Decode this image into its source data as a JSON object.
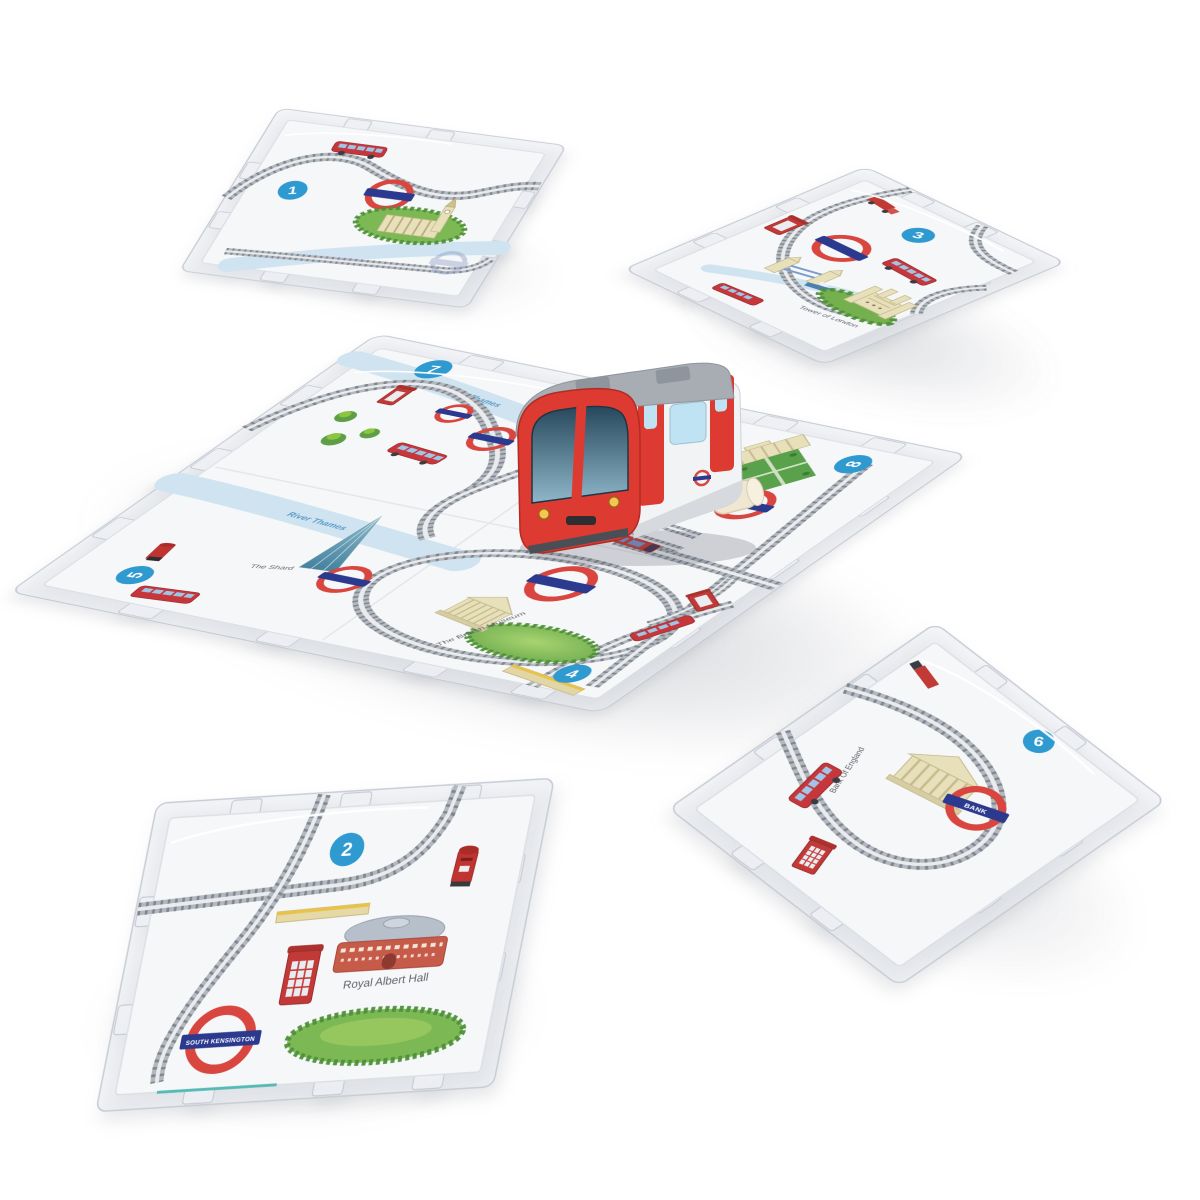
{
  "badges": {
    "t1": "1",
    "t2": "2",
    "t3": "3",
    "t4": "4",
    "t5": "5",
    "t6": "6",
    "t7": "7",
    "t8": "8"
  },
  "labels": {
    "river_thames": "River Thames",
    "the_shard": "The Shard",
    "british_museum": "The British Museum",
    "royal_albert_hall": "Royal Albert Hall",
    "tower_of_london": "Tower of London",
    "bank_of_england": "Bank Of England",
    "south_kensington": "SOUTH KENSINGTON",
    "bank": "BANK"
  },
  "colors": {
    "roundel_red": "#d8463f",
    "roundel_blue": "#2b3a8f",
    "train_red": "#dd3a31",
    "tile_surface": "#f6f7f9",
    "track_grey": "#7f868e",
    "park_green": "#7cb854",
    "river_blue": "#cfe4f0",
    "badge_blue": "#2f9ad0",
    "stone_beige": "#e7e0ba"
  }
}
